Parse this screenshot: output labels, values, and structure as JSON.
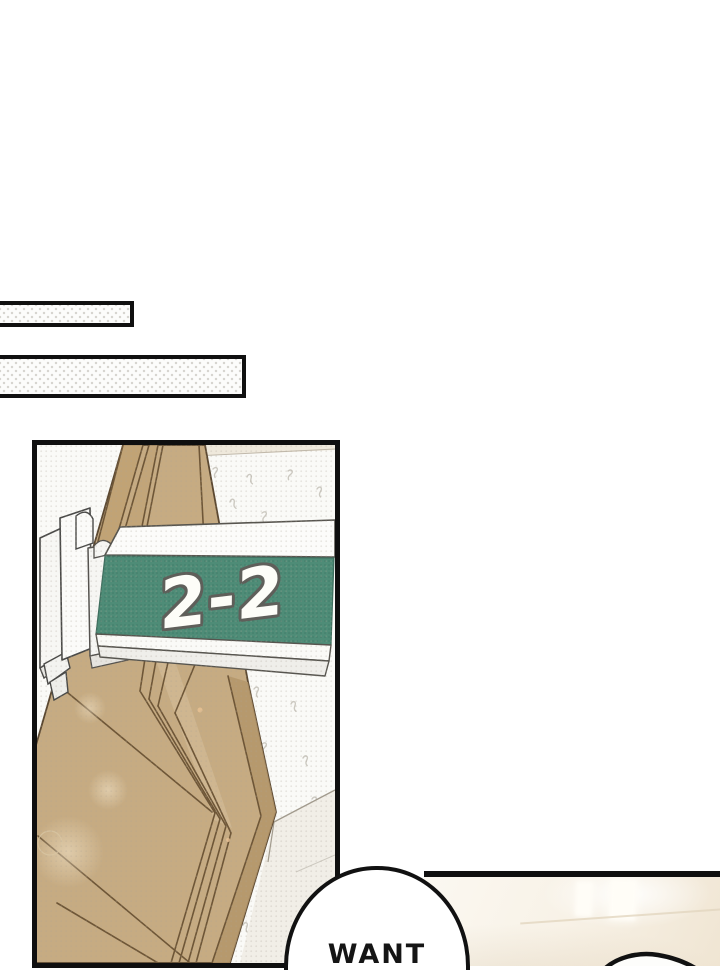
{
  "page": {
    "kind": "comic page",
    "background_color": "#ffffff",
    "width": 720,
    "height": 960
  },
  "narration_boxes": {
    "count": 2,
    "fill": "white halftone dots",
    "border_color": "#101010"
  },
  "door_panel": {
    "description": "wooden classroom door in steep perspective with room sign",
    "wall_color": "#fafaf7",
    "door_color": "#c6ab82",
    "border_color": "#0f0f0f",
    "sign": {
      "text": "2-2",
      "plate_color": "#4e8c77",
      "holder_color": "#fbfbf8",
      "text_color": "#fdfdf8"
    }
  },
  "corridor_panel": {
    "description": "bright corridor floor with window light",
    "floor_color": "#f3ead9",
    "border_color": "#0f0f0f"
  },
  "speech_bubble": {
    "text": "WANT",
    "fill": "#ffffff",
    "border_color": "#111111"
  }
}
